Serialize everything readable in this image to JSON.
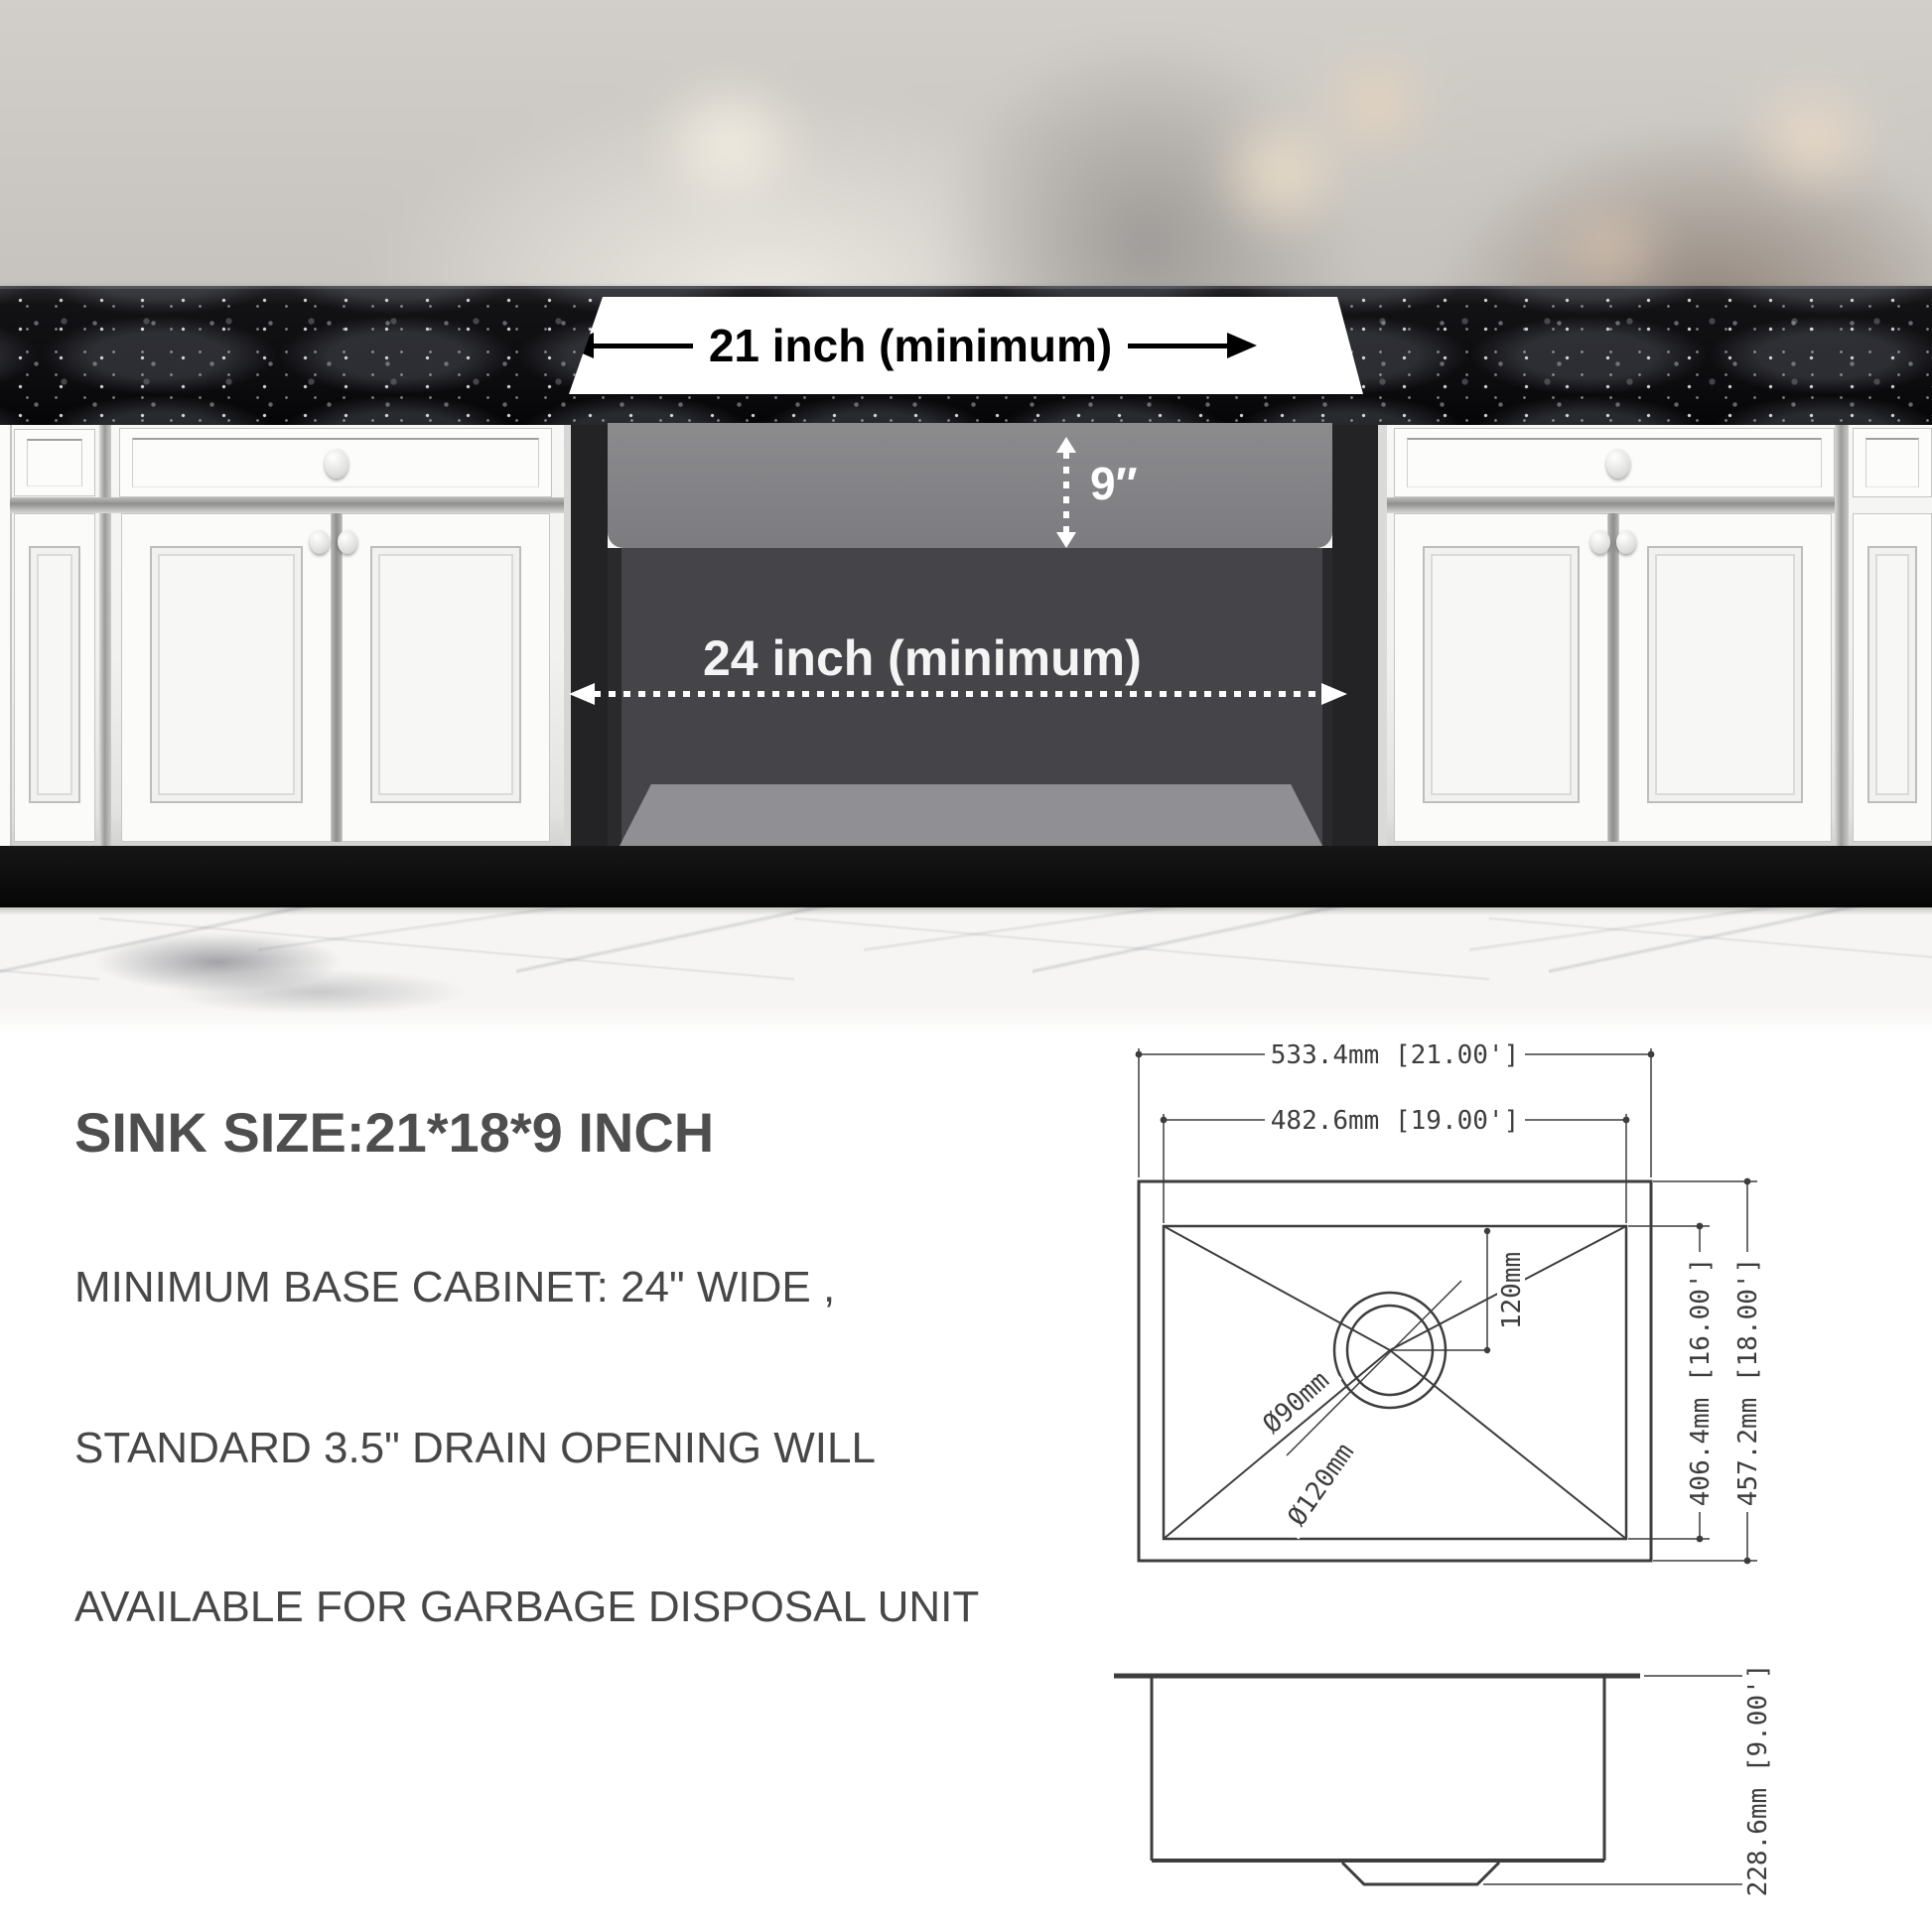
{
  "photo": {
    "countertop_width_label": "21 inch (minimum)",
    "cabinet_width_label": "24 inch (minimum)",
    "sink_depth_label": "9″"
  },
  "specs": {
    "title": "SINK SIZE:21*18*9 INCH",
    "lines": [
      "MINIMUM BASE CABINET: 24\" WIDE ,",
      "STANDARD 3.5\" DRAIN OPENING WILL",
      "AVAILABLE FOR GARBAGE DISPOSAL UNIT"
    ]
  },
  "drawing": {
    "top_view": {
      "outer_width": "533.4mm [21.00']",
      "bowl_width": "482.6mm [19.00']",
      "outer_depth": "457.2mm [18.00']",
      "bowl_depth": "406.4mm [16.00']",
      "drain_offset": "120mm",
      "drain_inner_diameter": "Ø90mm",
      "drain_outer_diameter": "Ø120mm"
    },
    "side_view": {
      "height": "228.6mm [9.00']"
    }
  }
}
